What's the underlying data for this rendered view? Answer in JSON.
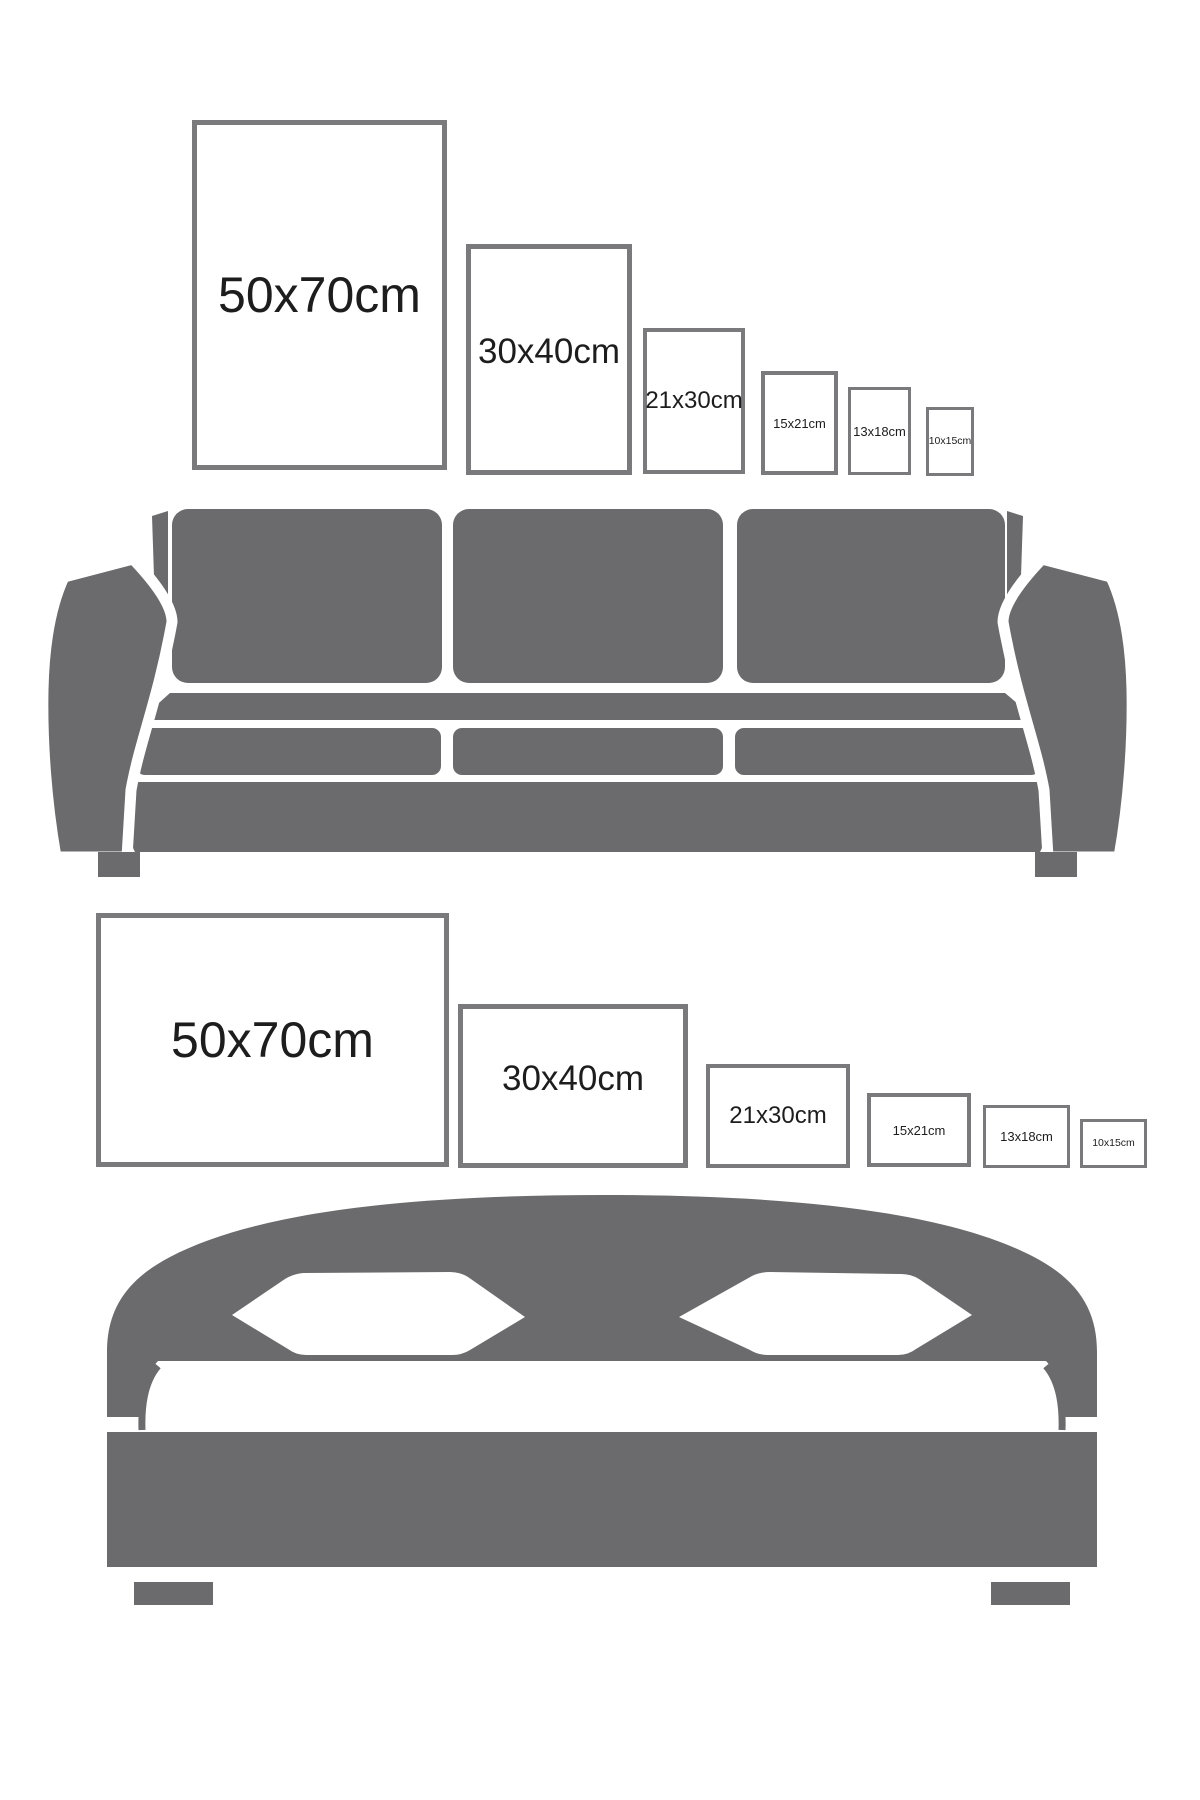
{
  "page": {
    "background": "#ffffff"
  },
  "colors": {
    "furniture_gray": "#6b6b6d",
    "frame_border": "#7a7a7c",
    "label_text": "#1d1d1d"
  },
  "icons": {
    "top_furniture": "sofa-icon",
    "bottom_furniture": "bed-icon"
  },
  "frames": {
    "portrait": [
      {
        "label": "50x70cm",
        "size_cm": "50x70"
      },
      {
        "label": "30x40cm",
        "size_cm": "30x40"
      },
      {
        "label": "21x30cm",
        "size_cm": "21x30"
      },
      {
        "label": "15x21cm",
        "size_cm": "15x21"
      },
      {
        "label": "13x18cm",
        "size_cm": "13x18"
      },
      {
        "label": "10x15cm",
        "size_cm": "10x15"
      }
    ],
    "landscape": [
      {
        "label": "50x70cm",
        "size_cm": "50x70"
      },
      {
        "label": "30x40cm",
        "size_cm": "30x40"
      },
      {
        "label": "21x30cm",
        "size_cm": "21x30"
      },
      {
        "label": "15x21cm",
        "size_cm": "15x21"
      },
      {
        "label": "13x18cm",
        "size_cm": "13x18"
      },
      {
        "label": "10x15cm",
        "size_cm": "10x15"
      }
    ]
  }
}
